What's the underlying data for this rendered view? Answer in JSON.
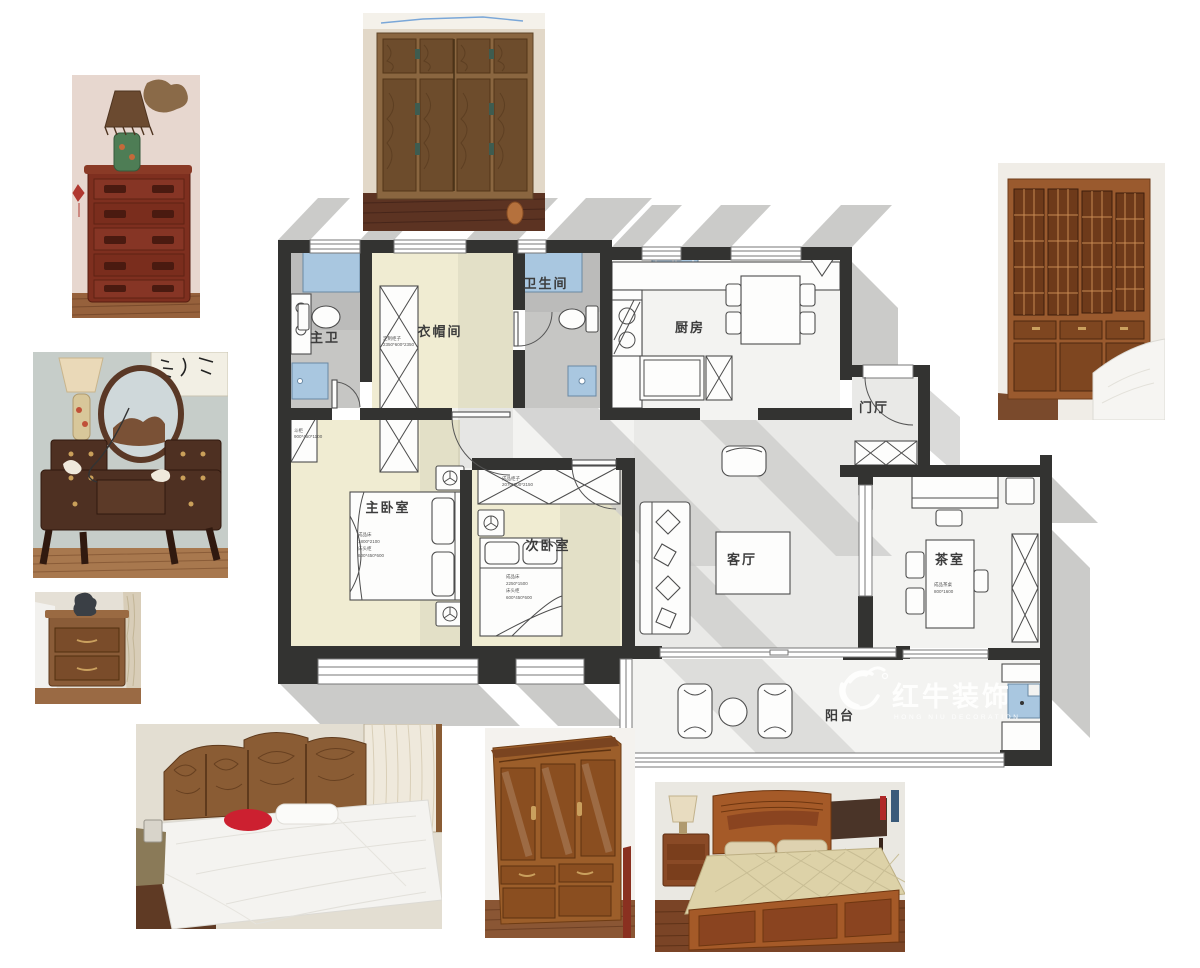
{
  "rooms": {
    "master_bath": "主卫",
    "cloakroom": "衣帽间",
    "bathroom": "卫生间",
    "kitchen": "厨房",
    "foyer": "门厅",
    "master_bedroom": "主卧室",
    "second_bedroom": "次卧室",
    "living_room": "客厅",
    "tea_room": "茶室",
    "balcony": "阳台"
  },
  "annotations": {
    "master_bed": [
      "成品床",
      "1800*2100",
      "床头柜",
      "600*450*600"
    ],
    "second_bed": [
      "成品床",
      "2250*1500",
      "床头柜",
      "600*450*600"
    ],
    "tea_table": [
      "成品茶桌",
      "800*1600"
    ],
    "cloak_wardrobe": [
      "定制柜子",
      "2350*600*2350"
    ],
    "second_wardrobe": [
      "成品柜子",
      "2070*600*2150"
    ],
    "dresser": [
      "斗柜",
      "900*450*1100"
    ]
  },
  "watermark": {
    "cn": "红牛装饰",
    "en": "HONG NIU DECORATION"
  },
  "colors": {
    "wall": "#333331",
    "floor_yellow": "#f0ecd2",
    "floor_gray": "#e9e9e7",
    "window_blue": "#a9c7e0",
    "shadow": "#cbcbc9",
    "watermark": "#ffffff"
  },
  "photos": [
    {
      "id": "chest-with-lamp"
    },
    {
      "id": "carved-wardrobe-tall"
    },
    {
      "id": "lattice-wardrobe"
    },
    {
      "id": "vanity-with-mirror"
    },
    {
      "id": "nightstand"
    },
    {
      "id": "bed-carved-headboard"
    },
    {
      "id": "glossy-wardrobe"
    },
    {
      "id": "wooden-bed"
    }
  ]
}
